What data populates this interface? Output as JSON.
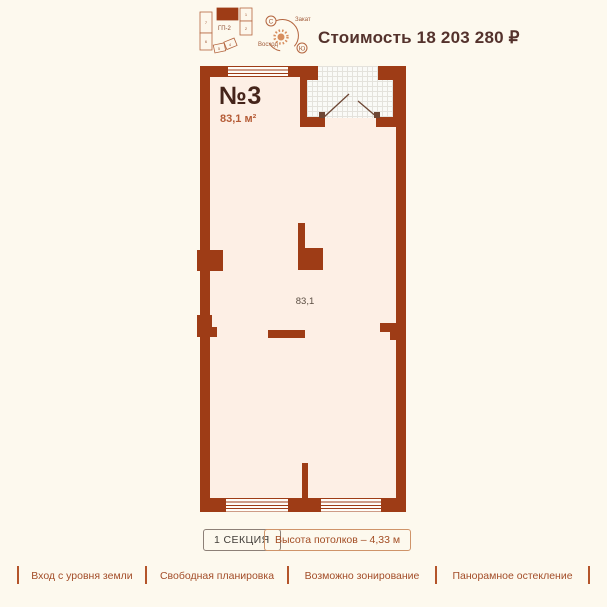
{
  "page": {
    "bg": "#fdf9ee",
    "accent": "#a34d28",
    "wall_color": "#9e3c16",
    "floor_color": "#fdefe5"
  },
  "header": {
    "site_plan": {
      "label": "ГП-2",
      "block_numbers": [
        "7",
        "6",
        "5",
        "4",
        "2",
        "1"
      ]
    },
    "compass": {
      "north_letter": "С",
      "south_letter": "Ю",
      "sunset_label": "Закат",
      "sunrise_label": "Восход"
    },
    "price_label": "Стоимость 18 203 280 ₽"
  },
  "plan": {
    "unit_number": "№3",
    "unit_area": "83,1 м²",
    "room_area_label": "83,1"
  },
  "info_badges": {
    "section_label": "1 СЕКЦИЯ",
    "ceiling_height_label": "Высота потолков – 4,33 м"
  },
  "features": [
    "Вход с уровня земли",
    "Свободная планировка",
    "Возможно зонирование",
    "Панорамное остекление"
  ]
}
